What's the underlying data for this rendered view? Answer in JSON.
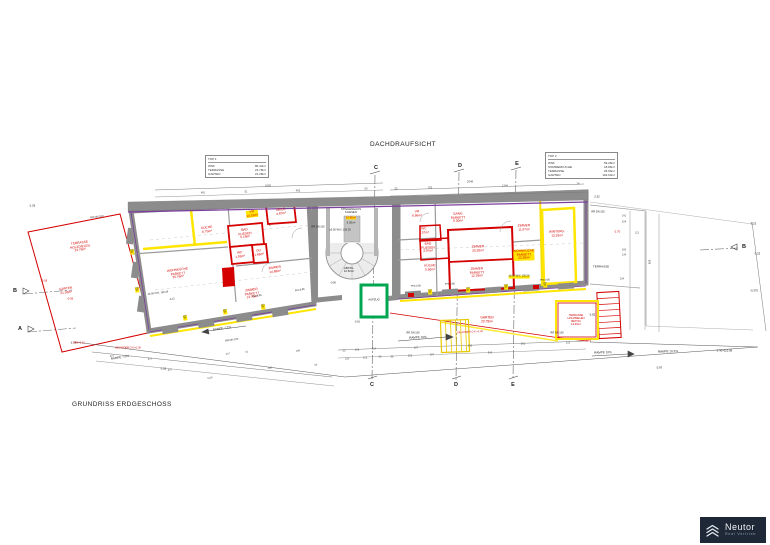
{
  "title": "DACHDRAUFSICHT",
  "caption": "GRUNDRISS ERDGESCHOSS",
  "logo": {
    "name": "Neutor",
    "tagline": "Real Vertrieb"
  },
  "tables": {
    "top1": {
      "header": "TOP 1",
      "rows": [
        {
          "label": "WNF",
          "value": "86.44m²"
        },
        {
          "label": "TERRASSE",
          "value": "23.78m²"
        },
        {
          "label": "GARTEN",
          "value": "21.28m²"
        }
      ]
    },
    "top2": {
      "header": "TOP 2",
      "rows": [
        {
          "label": "WNF",
          "value": "59.28m²"
        },
        {
          "label": "SOMMERKÜCHE",
          "value": "18.86m²"
        },
        {
          "label": "TERRASSE",
          "value": "26.96m²"
        },
        {
          "label": "GARTEN",
          "value": "102.64m²"
        }
      ]
    }
  },
  "plan": {
    "colors": {
      "red": "#d40000",
      "dark": "#222222",
      "dim": "#4a4a4a",
      "highlight": "#ffe500",
      "wall": "#8c8c8c",
      "purple": "#7b3f9d",
      "green": "#00a650",
      "yellow": "#ffe500",
      "logo_bg": "#1e2836"
    },
    "sections": [
      {
        "t": "C",
        "x": 376,
        "y": 168
      },
      {
        "t": "C",
        "x": 372,
        "y": 385
      },
      {
        "t": "D",
        "x": 460,
        "y": 166
      },
      {
        "t": "D",
        "x": 456,
        "y": 385
      },
      {
        "t": "E",
        "x": 517,
        "y": 164
      },
      {
        "t": "E",
        "x": 513,
        "y": 385
      },
      {
        "t": "B",
        "x": 15,
        "y": 291
      },
      {
        "t": "A",
        "x": 20,
        "y": 329
      },
      {
        "t": "B",
        "x": 744,
        "y": 247
      }
    ],
    "labels": [
      {
        "t": "KÜCHE\n6.75m²",
        "x": 207,
        "y": 230,
        "c": "r",
        "r": -7
      },
      {
        "t": "VR\n14.15m²",
        "x": 252,
        "y": 214,
        "c": "r",
        "r": -7,
        "b": 1
      },
      {
        "t": "DIELE\n4.87m²",
        "x": 281,
        "y": 212,
        "c": "r",
        "r": -7
      },
      {
        "t": "BAD\nFLIESEN\n5.18m²",
        "x": 245,
        "y": 234,
        "c": "r",
        "r": -7
      },
      {
        "t": "WC\n1.59m²",
        "x": 240,
        "y": 255,
        "c": "r",
        "r": -7
      },
      {
        "t": "DU\n1.68m²",
        "x": 259,
        "y": 253,
        "c": "r",
        "r": -7
      },
      {
        "t": "WOHNKÜCHE\nPARKETT\n35.76m²",
        "x": 178,
        "y": 274,
        "c": "r",
        "r": -7
      },
      {
        "t": "ZIMMER\n14.88m²",
        "x": 275,
        "y": 270,
        "c": "r",
        "r": -7
      },
      {
        "t": "ZIMMER\nPARKETT\n13.70m²",
        "x": 252,
        "y": 294,
        "c": "r",
        "r": -7
      },
      {
        "t": "STIEGENHAUS\nFLIESEN",
        "x": 351,
        "y": 211,
        "c": "k",
        "s": 2.8
      },
      {
        "t": "14.86m²",
        "x": 351,
        "y": 218,
        "c": "r",
        "s": 2.8,
        "b": 1
      },
      {
        "t": "9.05m²",
        "x": 351,
        "y": 223,
        "c": "k",
        "s": 2.8
      },
      {
        "t": "±0.00 W.N. 126.26",
        "x": 340,
        "y": 231,
        "c": "k",
        "s": 2.6
      },
      {
        "t": "ABSTG.\n10.52m²",
        "x": 349,
        "y": 270,
        "c": "k",
        "s": 2.8
      },
      {
        "t": "AUFZUG",
        "x": 374,
        "y": 300,
        "c": "k",
        "s": 2.8
      },
      {
        "t": "VR\n6.86m²",
        "x": 417,
        "y": 214,
        "c": "r",
        "r": -2
      },
      {
        "t": "GANG\nPARKETT\n8.30m²",
        "x": 458,
        "y": 218,
        "c": "r",
        "r": -2
      },
      {
        "t": "ZIMMER\n11.87m²",
        "x": 524,
        "y": 228,
        "c": "r",
        "r": -2
      },
      {
        "t": "ZIMMER\n20.30m²",
        "x": 478,
        "y": 249,
        "c": "r",
        "r": -2
      },
      {
        "t": "ZIMMER\nPARKETT\n12.29m²",
        "x": 477,
        "y": 273,
        "c": "r",
        "r": -2
      },
      {
        "t": "WOHNKÜCHE\nPARKETT\n23.55m²",
        "x": 524,
        "y": 255,
        "c": "r",
        "r": -2,
        "b": 1
      },
      {
        "t": "WC\n1.57m²",
        "x": 424,
        "y": 231,
        "c": "r",
        "r": -2
      },
      {
        "t": "BAD\nFLIESEN\n3.97m²",
        "x": 428,
        "y": 248,
        "c": "r",
        "r": -2
      },
      {
        "t": "KÜCHE\n5.60m²",
        "x": 430,
        "y": 268,
        "c": "r",
        "r": -2
      },
      {
        "t": "WINTERG.\n13.33m²",
        "x": 557,
        "y": 234,
        "c": "r",
        "r": -2
      },
      {
        "t": "TERRASSE",
        "x": 601,
        "y": 267,
        "c": "k",
        "s": 3
      },
      {
        "t": "GARTEN\n20.75m²",
        "x": 487,
        "y": 320,
        "c": "r"
      },
      {
        "t": "TERRASSE\nHOLZDIELEN\nBETON\n12.93m²",
        "x": 576,
        "y": 320,
        "c": "r",
        "s": 2.7
      },
      {
        "t": "TERRASSE\nHOLZDIELEN\n23.78m²",
        "x": 80,
        "y": 247,
        "c": "r",
        "r": -7
      },
      {
        "t": "GARTEN\n21.28m²",
        "x": 66,
        "y": 291,
        "c": "r",
        "r": -7
      },
      {
        "t": "RAMPE 7.0%",
        "x": 120,
        "y": 358,
        "c": "k",
        "s": 3,
        "r": -9
      },
      {
        "t": "RAMPE 7.2%",
        "x": 222,
        "y": 329,
        "c": "k",
        "s": 3,
        "r": -9
      },
      {
        "t": "RAMPE 10%",
        "x": 418,
        "y": 338,
        "c": "k",
        "s": 3,
        "r": -3
      },
      {
        "t": "RAMPE 10%",
        "x": 603,
        "y": 353,
        "c": "k",
        "s": 3,
        "r": -2
      },
      {
        "t": "RAMPE 10.2%",
        "x": 668,
        "y": 352,
        "c": "k",
        "s": 3,
        "r": -2
      },
      {
        "t": "RR DN 100",
        "x": 97,
        "y": 218,
        "c": "k",
        "s": 2.6,
        "r": -7
      },
      {
        "t": "RR DN 100",
        "x": 318,
        "y": 228,
        "c": "k",
        "s": 2.6
      },
      {
        "t": "RR DN 100",
        "x": 232,
        "y": 341,
        "c": "k",
        "s": 2.6,
        "r": -9
      },
      {
        "t": "RR DN 100",
        "x": 413,
        "y": 334,
        "c": "k",
        "s": 2.6
      },
      {
        "t": "RR DN 100",
        "x": 557,
        "y": 334,
        "c": "k",
        "s": 2.6
      },
      {
        "t": "RR DN 100",
        "x": 598,
        "y": 213,
        "c": "k",
        "s": 2.6
      },
      {
        "t": "2.52",
        "x": 597,
        "y": 197,
        "c": "k",
        "s": 2.8
      },
      {
        "t": "-2.70",
        "x": 617,
        "y": 232,
        "c": "r",
        "s": 2.8
      },
      {
        "t": "-1.29",
        "x": 32,
        "y": 206,
        "c": "k",
        "s": 2.8
      },
      {
        "t": "-3.23",
        "x": 753,
        "y": 224,
        "c": "k",
        "s": 2.8
      },
      {
        "t": "-3.23",
        "x": 757,
        "y": 254,
        "c": "k",
        "s": 2.8
      },
      {
        "t": "-0.375",
        "x": 754,
        "y": 291,
        "c": "k",
        "s": 2.8
      },
      {
        "t": "-3.40=112.89",
        "x": 724,
        "y": 351,
        "c": "k",
        "s": 2.8
      },
      {
        "t": "-2.87",
        "x": 659,
        "y": 368,
        "c": "k",
        "s": 2.8
      },
      {
        "t": "-2.82",
        "x": 592,
        "y": 315,
        "c": "k",
        "s": 2.8
      },
      {
        "t": "-0.81",
        "x": 588,
        "y": 341,
        "c": "r",
        "s": 2.8
      },
      {
        "t": "-1.02",
        "x": 163,
        "y": 369,
        "c": "k",
        "s": 2.8
      },
      {
        "t": "-1.79",
        "x": 73,
        "y": 343,
        "c": "k",
        "s": 2.8
      },
      {
        "t": "-0.18",
        "x": 44,
        "y": 281,
        "c": "r",
        "s": 2.8
      },
      {
        "t": "-0.05",
        "x": 70,
        "y": 299,
        "c": "r",
        "s": 2.8
      },
      {
        "t": "-0.12",
        "x": 172,
        "y": 300,
        "c": "k",
        "s": 2.5,
        "r": -7
      },
      {
        "t": "±0.00 W.N. 126.26",
        "x": 158,
        "y": 294,
        "c": "k",
        "s": 2.5,
        "r": -7
      },
      {
        "t": "±0.00 W.N. 126.26",
        "x": 519,
        "y": 277,
        "c": "k",
        "s": 2.5,
        "b": 1
      },
      {
        "t": "-0.90",
        "x": 333,
        "y": 284,
        "c": "k",
        "s": 2.5
      },
      {
        "t": "-0.91",
        "x": 357,
        "y": 323,
        "c": "k",
        "s": 2.5
      },
      {
        "t": "PH=0.85",
        "x": 257,
        "y": 297,
        "c": "k",
        "s": 2.5,
        "r": -9
      },
      {
        "t": "PH=0.85",
        "x": 300,
        "y": 291,
        "c": "k",
        "s": 2.5,
        "r": -9
      },
      {
        "t": "PH=0.85",
        "x": 416,
        "y": 287,
        "c": "k",
        "s": 2.5,
        "r": -2
      },
      {
        "t": "PH=0.85",
        "x": 450,
        "y": 285,
        "c": "k",
        "s": 2.5,
        "r": -2
      },
      {
        "t": "PH=0.85",
        "x": 545,
        "y": 281,
        "c": "k",
        "s": 2.5,
        "r": -2
      },
      {
        "t": "BOK=1.10",
        "x": 79,
        "y": 344,
        "c": "r",
        "s": 2.5
      },
      {
        "t": "GELÄNDER O.K.=1.00",
        "x": 128,
        "y": 349,
        "c": "r",
        "s": 2.5
      },
      {
        "t": "GELÄNDER O.K.=1.00",
        "x": 470,
        "y": 333,
        "c": "r",
        "s": 2.5,
        "r": -3
      },
      {
        "t": "1050",
        "x": 268,
        "y": 186,
        "c": "d",
        "s": 2.8
      },
      {
        "t": "481",
        "x": 203,
        "y": 194,
        "c": "d",
        "s": 2.6
      },
      {
        "t": "51",
        "x": 246,
        "y": 193,
        "c": "d",
        "s": 2.6
      },
      {
        "t": "455",
        "x": 298,
        "y": 192,
        "c": "d",
        "s": 2.6
      },
      {
        "t": "59",
        "x": 366,
        "y": 190,
        "c": "d",
        "s": 2.6
      },
      {
        "t": "2048",
        "x": 470,
        "y": 182,
        "c": "d",
        "s": 2.8
      },
      {
        "t": "703",
        "x": 430,
        "y": 189,
        "c": "d",
        "s": 2.6
      },
      {
        "t": "25",
        "x": 396,
        "y": 190,
        "c": "d",
        "s": 2.6
      },
      {
        "t": "1244",
        "x": 505,
        "y": 187,
        "c": "d",
        "s": 2.6
      },
      {
        "t": "24",
        "x": 578,
        "y": 185,
        "c": "d",
        "s": 2.6
      },
      {
        "t": "50",
        "x": 344,
        "y": 352,
        "c": "d",
        "s": 2.5
      },
      {
        "t": "106",
        "x": 357,
        "y": 351,
        "c": "d",
        "s": 2.5
      },
      {
        "t": "214",
        "x": 374,
        "y": 350,
        "c": "d",
        "s": 2.5
      },
      {
        "t": "187",
        "x": 416,
        "y": 349,
        "c": "d",
        "s": 2.5
      },
      {
        "t": "343",
        "x": 470,
        "y": 347,
        "c": "d",
        "s": 2.5
      },
      {
        "t": "561",
        "x": 523,
        "y": 345,
        "c": "d",
        "s": 2.5
      },
      {
        "t": "332",
        "x": 568,
        "y": 344,
        "c": "d",
        "s": 2.5
      },
      {
        "t": "119",
        "x": 347,
        "y": 360,
        "c": "d",
        "s": 2.5
      },
      {
        "t": "123",
        "x": 365,
        "y": 359,
        "c": "d",
        "s": 2.5
      },
      {
        "t": "60",
        "x": 380,
        "y": 358,
        "c": "d",
        "s": 2.5
      },
      {
        "t": "98",
        "x": 392,
        "y": 358,
        "c": "d",
        "s": 2.5
      },
      {
        "t": "203",
        "x": 410,
        "y": 357,
        "c": "d",
        "s": 2.5
      },
      {
        "t": "207",
        "x": 432,
        "y": 356,
        "c": "d",
        "s": 2.5
      },
      {
        "t": "543",
        "x": 490,
        "y": 354,
        "c": "d",
        "s": 2.5
      },
      {
        "t": "221",
        "x": 112,
        "y": 357,
        "c": "d",
        "s": 2.5,
        "r": -9
      },
      {
        "t": "475",
        "x": 170,
        "y": 371,
        "c": "d",
        "s": 2.5,
        "r": -9
      },
      {
        "t": "237",
        "x": 228,
        "y": 355,
        "c": "d",
        "s": 2.5,
        "r": -9
      },
      {
        "t": "51",
        "x": 247,
        "y": 353,
        "c": "d",
        "s": 2.5,
        "r": -9
      },
      {
        "t": "448",
        "x": 270,
        "y": 369,
        "c": "d",
        "s": 2.5,
        "r": -9
      },
      {
        "t": "199",
        "x": 298,
        "y": 352,
        "c": "d",
        "s": 2.5,
        "r": -9
      },
      {
        "t": "54",
        "x": 316,
        "y": 366,
        "c": "d",
        "s": 2.5,
        "r": -9
      },
      {
        "t": "1119",
        "x": 210,
        "y": 379,
        "c": "d",
        "s": 2.5,
        "r": -9
      },
      {
        "t": "473",
        "x": 150,
        "y": 360,
        "c": "d",
        "s": 2.5,
        "r": -9
      },
      {
        "t": "141",
        "x": 624,
        "y": 217,
        "c": "d",
        "s": 2.5
      },
      {
        "t": "104",
        "x": 624,
        "y": 223,
        "c": "d",
        "s": 2.5
      },
      {
        "t": "121",
        "x": 637,
        "y": 234,
        "c": "d",
        "s": 2.5
      },
      {
        "t": "180",
        "x": 624,
        "y": 251,
        "c": "d",
        "s": 2.5
      },
      {
        "t": "134",
        "x": 624,
        "y": 256,
        "c": "d",
        "s": 2.5
      },
      {
        "t": "898",
        "x": 648,
        "y": 262,
        "c": "d",
        "s": 2.5,
        "r": 90
      },
      {
        "t": "104",
        "x": 622,
        "y": 280,
        "c": "d",
        "s": 2.5
      },
      {
        "t": "100\n94",
        "x": 185,
        "y": 318,
        "c": "k",
        "s": 2.2,
        "b": 1,
        "r": -9
      },
      {
        "t": "100\n94",
        "x": 225,
        "y": 312,
        "c": "k",
        "s": 2.2,
        "b": 1,
        "r": -9
      },
      {
        "t": "100\n94",
        "x": 263,
        "y": 307,
        "c": "k",
        "s": 2.2,
        "b": 1,
        "r": -9
      },
      {
        "t": "100\n94",
        "x": 132,
        "y": 252,
        "c": "k",
        "s": 2.2,
        "b": 1,
        "r": -7
      },
      {
        "t": "100\n94",
        "x": 137,
        "y": 290,
        "c": "k",
        "s": 2.2,
        "b": 1,
        "r": -7
      },
      {
        "t": "100\n94",
        "x": 430,
        "y": 292,
        "c": "k",
        "s": 2.2,
        "b": 1,
        "r": -2
      },
      {
        "t": "100\n94",
        "x": 468,
        "y": 290,
        "c": "k",
        "s": 2.2,
        "b": 1,
        "r": -2
      },
      {
        "t": "100\n94",
        "x": 506,
        "y": 287,
        "c": "k",
        "s": 2.2,
        "b": 1,
        "r": -2
      },
      {
        "t": "100\n94",
        "x": 545,
        "y": 285,
        "c": "k",
        "s": 2.2,
        "b": 1,
        "r": -2
      }
    ]
  }
}
